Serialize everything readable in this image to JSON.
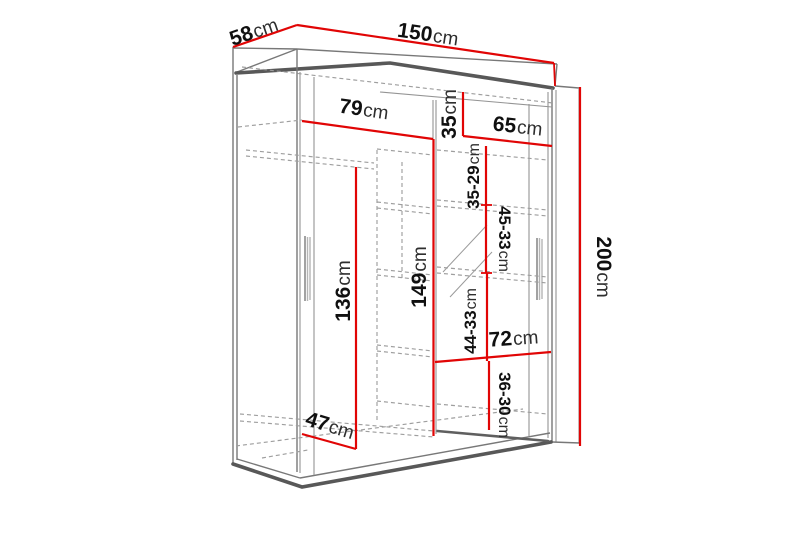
{
  "diagram": {
    "description": "Sliding-door wardrobe technical dimension drawing",
    "unit": "cm",
    "colors": {
      "dimension_line": "#e10505",
      "structure_line": "#787878",
      "hidden_line": "#9e9e9e",
      "background": "#ffffff",
      "label_number": "#101010",
      "label_unit": "#2e2e2e"
    },
    "labels": {
      "depth58": {
        "value": "58",
        "unit": "cm"
      },
      "width150": {
        "value": "150",
        "unit": "cm"
      },
      "height200": {
        "value": "200",
        "unit": "cm"
      },
      "width79": {
        "value": "79",
        "unit": "cm"
      },
      "height35": {
        "value": "35",
        "unit": "cm"
      },
      "width65": {
        "value": "65",
        "unit": "cm"
      },
      "range35_29": {
        "value": "35-29",
        "unit": "cm"
      },
      "range45_33": {
        "value": "45-33",
        "unit": "cm"
      },
      "range44_33": {
        "value": "44-33",
        "unit": "cm"
      },
      "range36_30": {
        "value": "36-30",
        "unit": "cm"
      },
      "height149": {
        "value": "149",
        "unit": "cm"
      },
      "height136": {
        "value": "136",
        "unit": "cm"
      },
      "width72": {
        "value": "72",
        "unit": "cm"
      },
      "depth47": {
        "value": "47",
        "unit": "cm"
      }
    }
  }
}
